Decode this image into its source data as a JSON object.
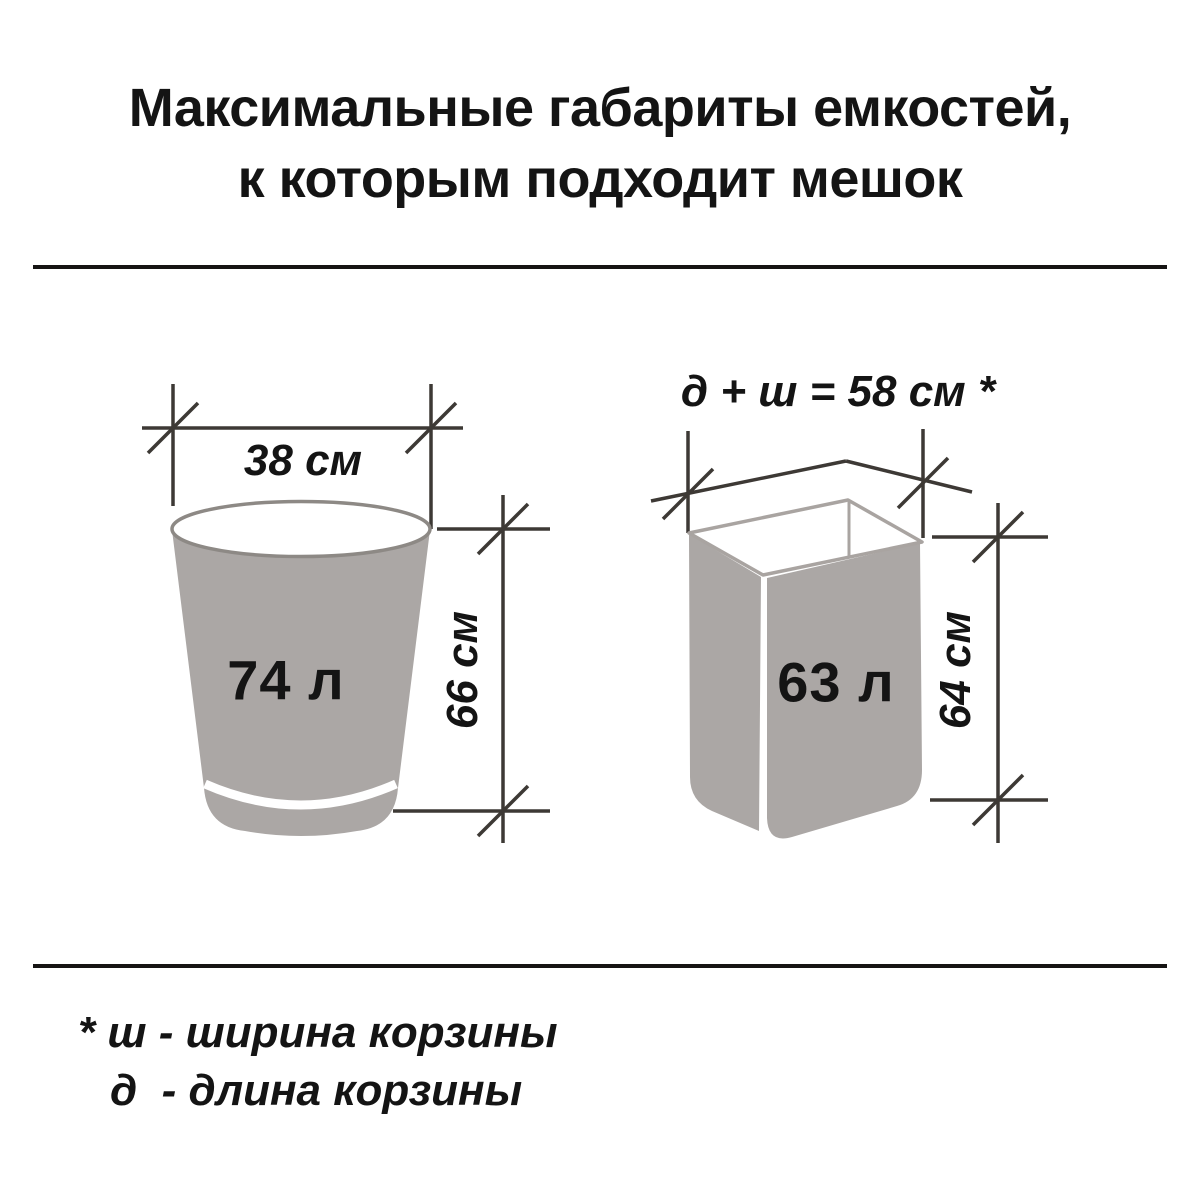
{
  "title": {
    "line1": "Максимальные габариты емкостей,",
    "line2": "к которым подходит мешок"
  },
  "bucket": {
    "volume": "74 л",
    "width": "38 см",
    "height": "66 см"
  },
  "basket": {
    "perimeter": "д + ш = 58 см *",
    "volume": "63 л",
    "height": "64 см"
  },
  "footnote": {
    "line1": "* ш - ширина корзины",
    "line2": "д  - длина корзины"
  },
  "colors": {
    "container_fill": "#aba7a5",
    "container_stroke": "#a9a4a1",
    "rim_stroke": "#8d8985",
    "dimension_line": "#3d3935",
    "divider": "#161413",
    "text": "#141414"
  }
}
